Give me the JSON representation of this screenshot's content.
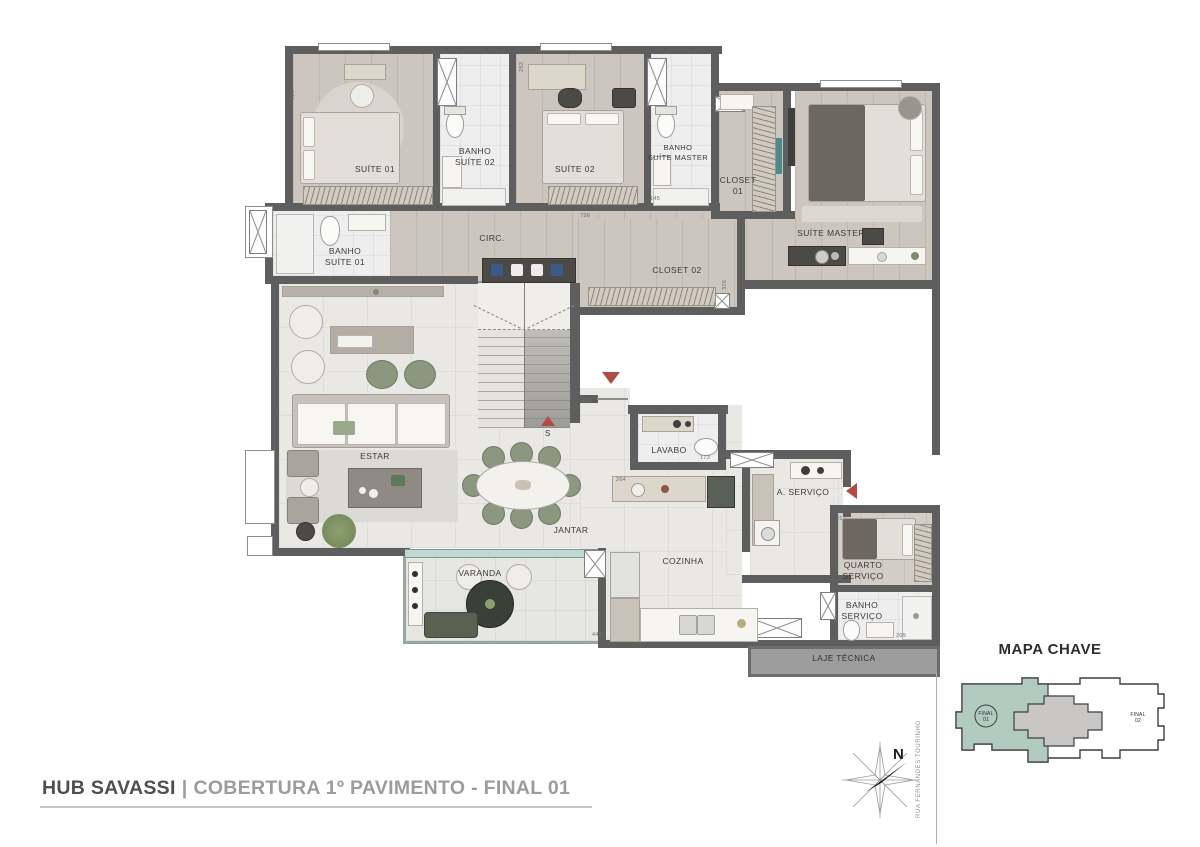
{
  "rooms": [
    {
      "id": "suite-01",
      "label": "SUÍTE 01"
    },
    {
      "id": "banho-suite-02",
      "label": "BANHO\nSUÍTE 02"
    },
    {
      "id": "suite-02",
      "label": "SUÍTE 02"
    },
    {
      "id": "banho-suite-master",
      "label": "BANHO\nSUÍTE MASTER"
    },
    {
      "id": "closet-01",
      "label": "CLOSET\n01"
    },
    {
      "id": "suite-master",
      "label": "SUÍTE MASTER"
    },
    {
      "id": "banho-suite-01",
      "label": "BANHO\nSUÍTE 01"
    },
    {
      "id": "circulacao",
      "label": "CIRC."
    },
    {
      "id": "closet-02",
      "label": "CLOSET 02"
    },
    {
      "id": "estar",
      "label": "ESTAR"
    },
    {
      "id": "jantar",
      "label": "JANTAR"
    },
    {
      "id": "lavabo",
      "label": "LAVABO"
    },
    {
      "id": "cozinha",
      "label": "COZINHA"
    },
    {
      "id": "area-servico",
      "label": "A. SERVIÇO"
    },
    {
      "id": "quarto-servico",
      "label": "QUARTO\nSERVIÇO"
    },
    {
      "id": "banho-servico",
      "label": "BANHO\nSERVIÇO"
    },
    {
      "id": "varanda",
      "label": "VARANDA"
    },
    {
      "id": "laje-tecnica",
      "label": "LAJE TÉCNICA"
    }
  ],
  "dims": [
    "320",
    "283",
    "798",
    "145",
    "326",
    "433",
    "173",
    "264",
    "212",
    "209",
    "448"
  ],
  "markers": {
    "stairs_label": "S"
  },
  "compass": {
    "north_label": "N"
  },
  "key_map": {
    "title": "MAPA CHAVE",
    "unit1_label": "FINAL\n01",
    "unit2_label": "FINAL\n02",
    "street": "RUA FERNANDES TOURINHO",
    "highlight_color": "#b2cbc1",
    "core_color": "#c8c7c5"
  },
  "footer": {
    "project": "HUB SAVASSI",
    "separator": "|",
    "subtitle": "COBERTURA 1º PAVIMENTO - FINAL 01"
  },
  "colors": {
    "wall": "#5e5e5e",
    "wood_floor": "#ccc6be",
    "tile_floor": "#e9e8e4",
    "accent_red": "#b14c42",
    "window_glass": "#bfd9d2"
  }
}
